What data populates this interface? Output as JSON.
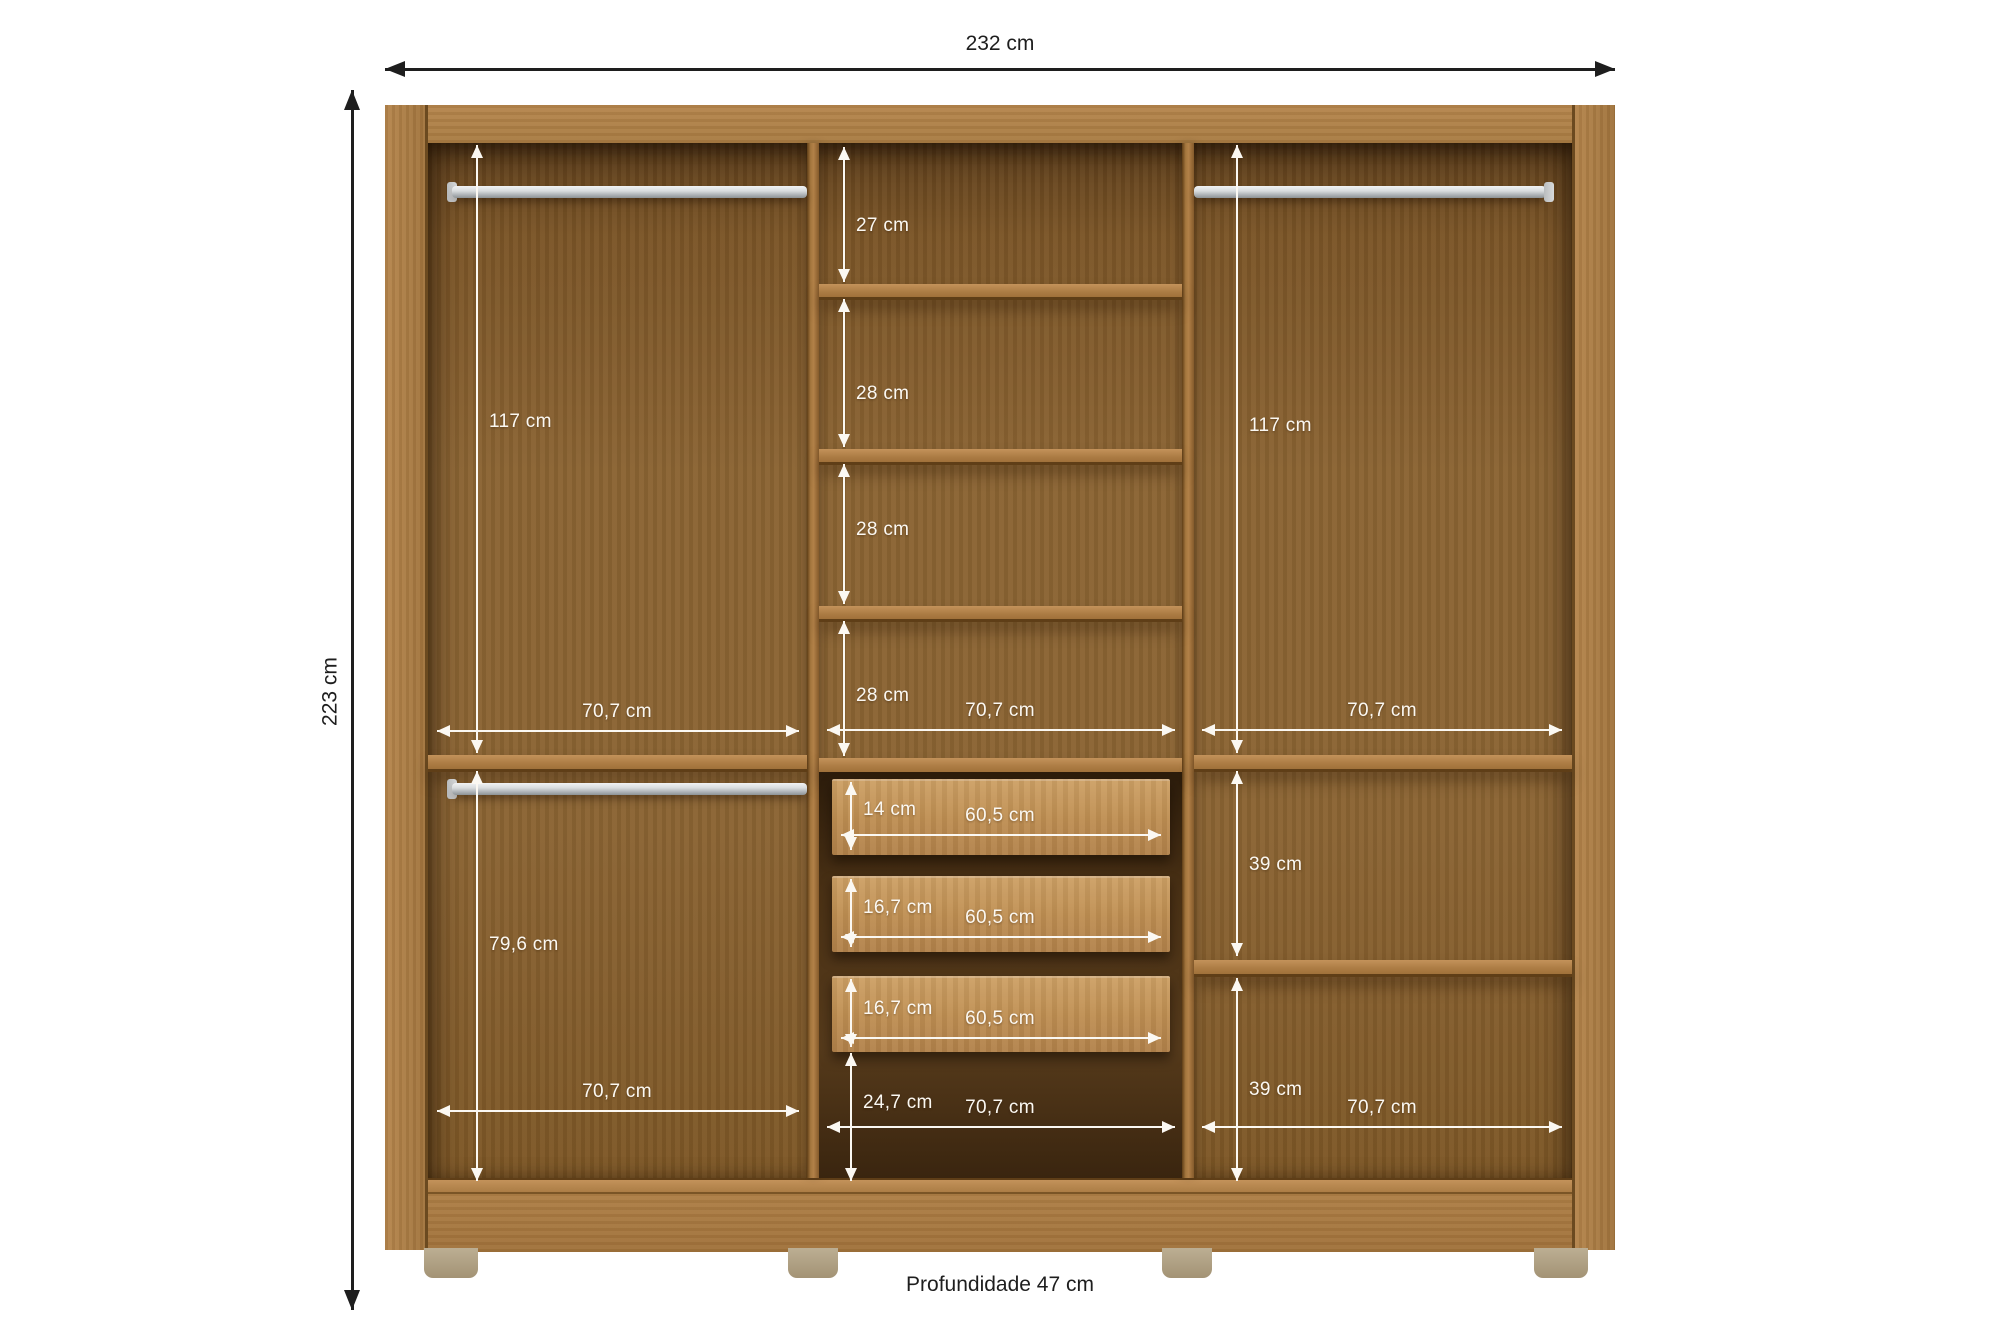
{
  "exterior": {
    "width": "232 cm",
    "height": "223 cm",
    "depth_note": "Profundidade 47 cm"
  },
  "left_section": {
    "upper_height": "117 cm",
    "upper_width": "70,7 cm",
    "lower_height": "79,6 cm",
    "lower_width": "70,7 cm"
  },
  "middle_section": {
    "gap_1": "27 cm",
    "gap_2": "28 cm",
    "gap_3": "28 cm",
    "gap_4": "28 cm",
    "upper_width": "70,7 cm",
    "drawer_1_height": "14 cm",
    "drawer_1_width": "60,5 cm",
    "drawer_2_height": "16,7 cm",
    "drawer_2_width": "60,5 cm",
    "drawer_3_height": "16,7 cm",
    "drawer_3_width": "60,5 cm",
    "bottom_gap": "24,7 cm",
    "bottom_width": "70,7 cm"
  },
  "right_section": {
    "upper_height": "117 cm",
    "upper_width": "70,7 cm",
    "shelf_gap_1": "39 cm",
    "shelf_gap_2": "39 cm",
    "bottom_width": "70,7 cm"
  },
  "colors": {
    "frame_wood": "#ab7c43",
    "back_panel": "#8a6334",
    "drawer_front": "#c09057",
    "rod_metal": "#d6d8da",
    "dimension_interior": "#fbf8f2",
    "dimension_exterior": "#1e1e1e",
    "feet": "#afa083"
  }
}
